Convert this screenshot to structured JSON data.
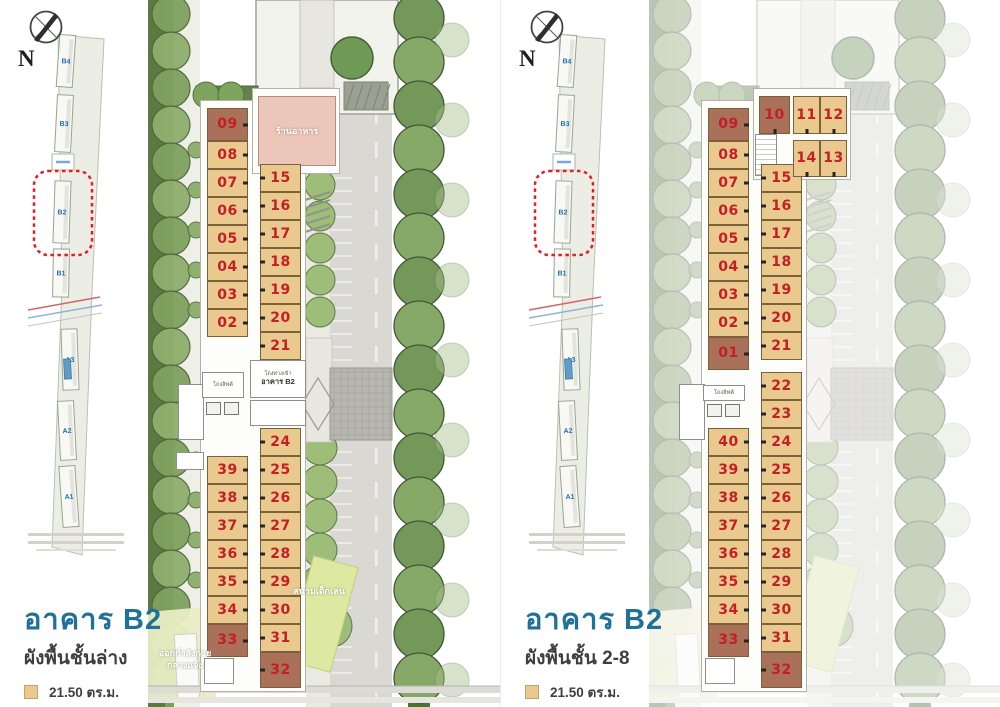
{
  "compass": {
    "label": "N"
  },
  "colors": {
    "title_blue": "#20719a",
    "unit_number_red": "#c41e26",
    "small_unit_fill": "#e9c98e",
    "large_unit_fill": "#a9705a",
    "highlight_dash_red": "#e51c23",
    "minimap_label_blue": "#1f6fb5"
  },
  "legend": {
    "items": [
      {
        "label": "21.50 ตร.ม.",
        "color": "#e9c98e"
      },
      {
        "label": "22.00 ตร.ม.",
        "color": "#a9705a"
      }
    ]
  },
  "minimap": {
    "buildings": [
      {
        "label": "B4"
      },
      {
        "label": "B3"
      },
      {
        "label": "B2",
        "highlighted": true
      },
      {
        "label": "B1"
      },
      {
        "label": "A3"
      },
      {
        "label": "A2"
      },
      {
        "label": "A1"
      }
    ]
  },
  "panels": [
    {
      "id": "ground-floor",
      "title": "อาคาร B2",
      "subtitle": "ผังพื้นชั้นล่าง",
      "labels": {
        "restaurant": "ร้านอาหาร",
        "lift_hall": "โถงลิฟต์",
        "entrance_hall_small": "โถงทางเข้า",
        "entrance_hall_name": "อาคาร B2",
        "playground": "สนามเด็กเล่น",
        "exercise_line1": "ออกกำลังกาย",
        "exercise_line2": "กลางแจ้ง"
      },
      "units": {
        "top_left": [
          {
            "no": "09",
            "type": "22.00"
          },
          {
            "no": "08",
            "type": "21.50"
          },
          {
            "no": "07",
            "type": "21.50"
          },
          {
            "no": "06",
            "type": "21.50"
          },
          {
            "no": "05",
            "type": "21.50"
          },
          {
            "no": "04",
            "type": "21.50"
          },
          {
            "no": "03",
            "type": "21.50"
          },
          {
            "no": "02",
            "type": "21.50"
          }
        ],
        "top_right": [
          {
            "no": "15",
            "type": "21.50"
          },
          {
            "no": "16",
            "type": "21.50"
          },
          {
            "no": "17",
            "type": "21.50"
          },
          {
            "no": "18",
            "type": "21.50"
          },
          {
            "no": "19",
            "type": "21.50"
          },
          {
            "no": "20",
            "type": "21.50"
          },
          {
            "no": "21",
            "type": "21.50"
          }
        ],
        "mid_right": [],
        "bottom_left": [
          {
            "no": "39",
            "type": "21.50"
          },
          {
            "no": "38",
            "type": "21.50"
          },
          {
            "no": "37",
            "type": "21.50"
          },
          {
            "no": "36",
            "type": "21.50"
          },
          {
            "no": "35",
            "type": "21.50"
          },
          {
            "no": "34",
            "type": "21.50"
          },
          {
            "no": "33",
            "type": "22.00"
          }
        ],
        "bottom_right": [
          {
            "no": "24",
            "type": "21.50"
          },
          {
            "no": "25",
            "type": "21.50"
          },
          {
            "no": "26",
            "type": "21.50"
          },
          {
            "no": "27",
            "type": "21.50"
          },
          {
            "no": "28",
            "type": "21.50"
          },
          {
            "no": "29",
            "type": "21.50"
          },
          {
            "no": "30",
            "type": "21.50"
          },
          {
            "no": "31",
            "type": "21.50"
          },
          {
            "no": "32",
            "type": "22.00"
          }
        ],
        "top_row": []
      }
    },
    {
      "id": "floors-2-8",
      "title": "อาคาร B2",
      "subtitle": "ผังพื้นชั้น 2-8",
      "labels": {
        "lift_hall": "โถงลิฟต์"
      },
      "units": {
        "top_left": [
          {
            "no": "09",
            "type": "22.00"
          },
          {
            "no": "08",
            "type": "21.50"
          },
          {
            "no": "07",
            "type": "21.50"
          },
          {
            "no": "06",
            "type": "21.50"
          },
          {
            "no": "05",
            "type": "21.50"
          },
          {
            "no": "04",
            "type": "21.50"
          },
          {
            "no": "03",
            "type": "21.50"
          },
          {
            "no": "02",
            "type": "21.50"
          },
          {
            "no": "01",
            "type": "22.00"
          }
        ],
        "top_right": [
          {
            "no": "15",
            "type": "21.50"
          },
          {
            "no": "16",
            "type": "21.50"
          },
          {
            "no": "17",
            "type": "21.50"
          },
          {
            "no": "18",
            "type": "21.50"
          },
          {
            "no": "19",
            "type": "21.50"
          },
          {
            "no": "20",
            "type": "21.50"
          },
          {
            "no": "21",
            "type": "21.50"
          }
        ],
        "mid_right": [
          {
            "no": "22",
            "type": "21.50"
          },
          {
            "no": "23",
            "type": "21.50"
          }
        ],
        "bottom_left": [
          {
            "no": "40",
            "type": "21.50"
          },
          {
            "no": "39",
            "type": "21.50"
          },
          {
            "no": "38",
            "type": "21.50"
          },
          {
            "no": "37",
            "type": "21.50"
          },
          {
            "no": "36",
            "type": "21.50"
          },
          {
            "no": "35",
            "type": "21.50"
          },
          {
            "no": "34",
            "type": "21.50"
          },
          {
            "no": "33",
            "type": "22.00"
          }
        ],
        "bottom_right": [
          {
            "no": "24",
            "type": "21.50"
          },
          {
            "no": "25",
            "type": "21.50"
          },
          {
            "no": "26",
            "type": "21.50"
          },
          {
            "no": "27",
            "type": "21.50"
          },
          {
            "no": "28",
            "type": "21.50"
          },
          {
            "no": "29",
            "type": "21.50"
          },
          {
            "no": "30",
            "type": "21.50"
          },
          {
            "no": "31",
            "type": "21.50"
          },
          {
            "no": "32",
            "type": "22.00"
          }
        ],
        "top_row": [
          {
            "no": "10",
            "type": "22.00"
          },
          {
            "no": "11",
            "type": "21.50"
          },
          {
            "no": "12",
            "type": "21.50"
          },
          {
            "no": "14",
            "type": "21.50"
          },
          {
            "no": "13",
            "type": "21.50"
          }
        ]
      }
    }
  ]
}
